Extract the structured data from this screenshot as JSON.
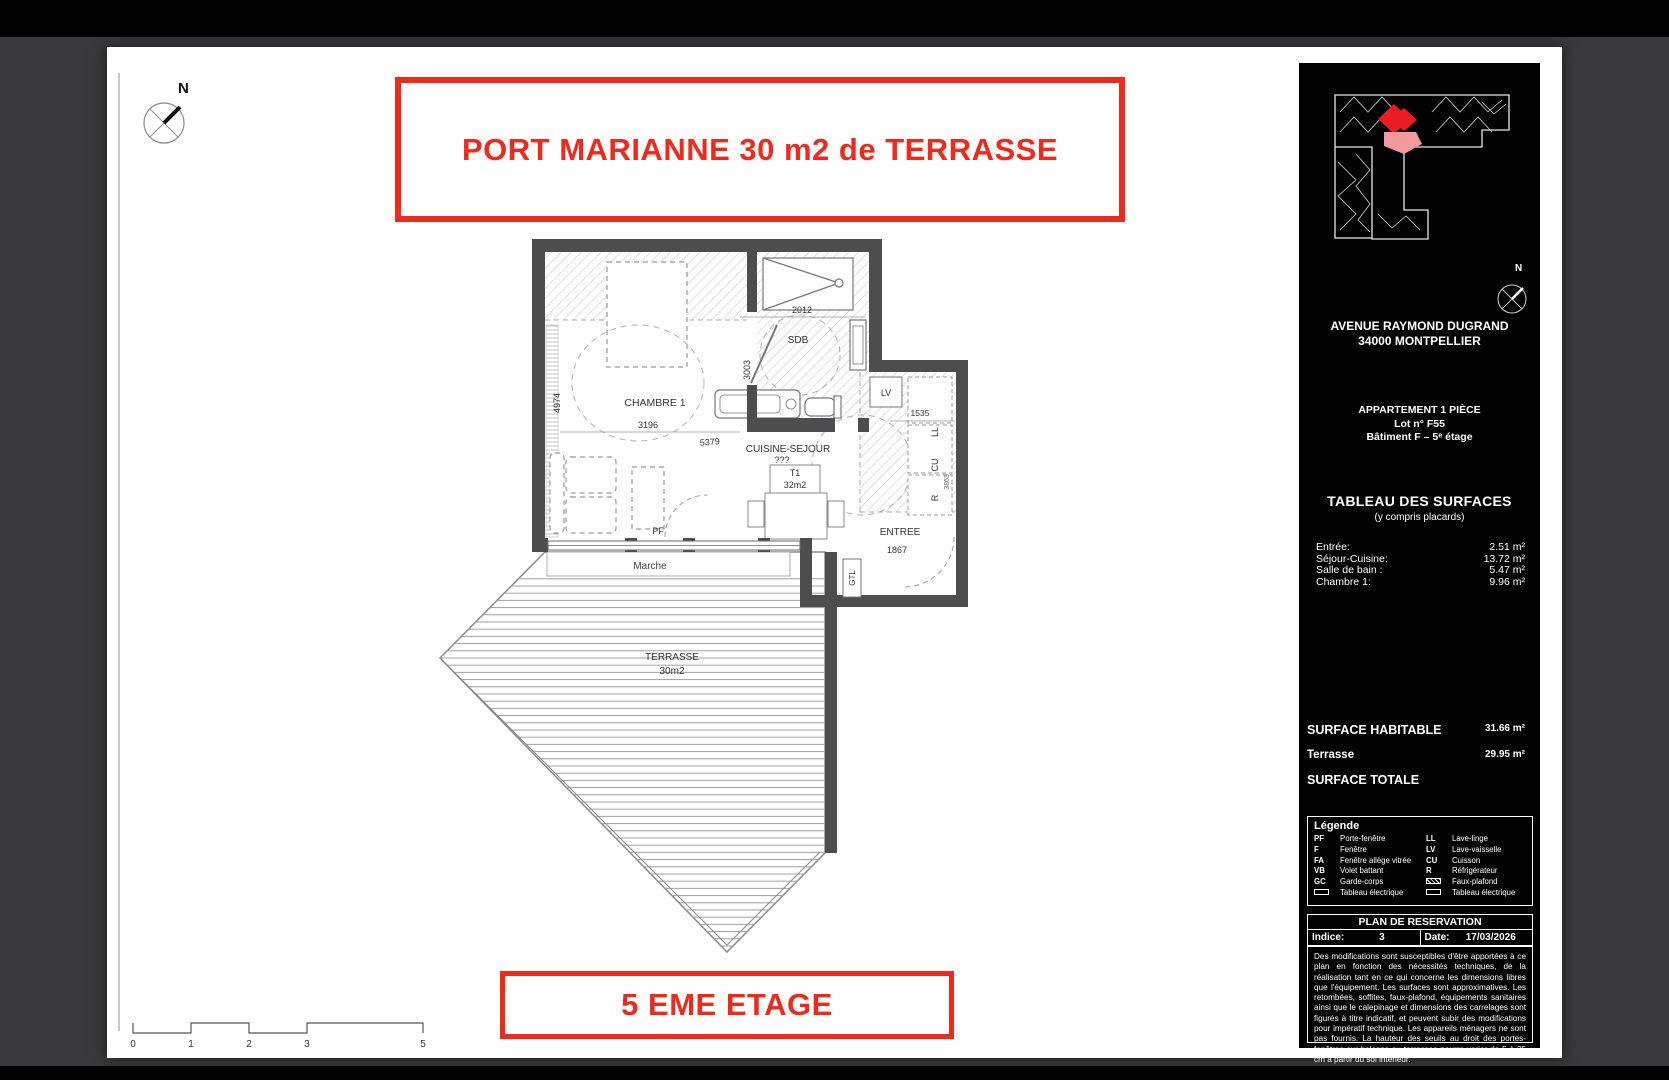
{
  "header": {
    "title": "PORT MARIANNE 30 m2 de TERRASSE"
  },
  "footer": {
    "floor_label": "5 EME ETAGE"
  },
  "compass": {
    "north": "N"
  },
  "scale_bar": {
    "t0": "0",
    "t1": "1",
    "t2": "2",
    "t3": "3",
    "t5": "5"
  },
  "plan": {
    "room_chambre": "CHAMBRE 1",
    "room_sdb": "SDB",
    "room_cuisine": "CUISINE-SEJOUR",
    "cuisine_note": "???",
    "room_entree": "ENTREE",
    "room_terrasse": "TERRASSE",
    "terrasse_area": "30m2",
    "unit_type": "T1",
    "unit_area": "32m2",
    "lbl_pf": "PF",
    "lbl_marche": "Marche",
    "lbl_gtl": "GTL",
    "lbl_lv": "LV",
    "lbl_ll": "LL",
    "lbl_cu": "CU",
    "lbl_r": "R",
    "dim_2012": "2012",
    "dim_3003": "3003",
    "dim_4974": "4974",
    "dim_3196": "3196",
    "dim_5379": "5379",
    "dim_1535": "1535",
    "dim_1867": "1867",
    "dim_3863": "3863"
  },
  "panel": {
    "north": "N",
    "address_line1": "AVENUE RAYMOND DUGRAND",
    "address_line2": "34000 MONTPELLIER",
    "apt_line1": "APPARTEMENT 1 PIÈCE",
    "apt_line2": "Lot n° F55",
    "apt_line3": "Bâtiment F – 5ᵉ étage",
    "surfaces_title": "TABLEAU DES SURFACES",
    "surfaces_subtitle": "(y compris placards)",
    "surfaces": [
      {
        "label": "Entrée:",
        "value": "2.51 m²"
      },
      {
        "label": "Séjour-Cuisine:",
        "value": "13.72 m²"
      },
      {
        "label": "Salle de bain :",
        "value": "5.47 m²"
      },
      {
        "label": "Chambre 1:",
        "value": "9.96 m²"
      }
    ],
    "total_habitable_label": "SURFACE HABITABLE",
    "total_habitable_value": "31.66 m²",
    "terrasse_label": "Terrasse",
    "terrasse_value": "29.95 m²",
    "total_label": "SURFACE TOTALE",
    "legend_title": "Légende",
    "legend_left": [
      {
        "code": "PF",
        "label": "Porte-fenêtre"
      },
      {
        "code": "F",
        "label": "Fenêtre"
      },
      {
        "code": "FA",
        "label": "Fenêtre allège vitrée"
      },
      {
        "code": "VB",
        "label": "Volet battant"
      },
      {
        "code": "GC",
        "label": "Garde-corps"
      },
      {
        "code": "",
        "label": "Tableau électrique"
      }
    ],
    "legend_right": [
      {
        "code": "LL",
        "label": "Lave-linge"
      },
      {
        "code": "LV",
        "label": "Lave-vaisselle"
      },
      {
        "code": "CU",
        "label": "Cuisson"
      },
      {
        "code": "R",
        "label": "Réfrigérateur"
      },
      {
        "code": "",
        "label": "Faux-plafond"
      },
      {
        "code": "",
        "label": "Tableau électrique"
      }
    ],
    "resa_title": "PLAN DE RESERVATION",
    "indice_label": "Indice:",
    "indice_value": "3",
    "date_label": "Date:",
    "date_value": "17/03/2026",
    "disclaimer": "Des modifications sont susceptibles d'être apportées à ce plan en fonction des nécessités techniques, de la réalisation tant en ce qui concerne les dimensions libres que l'équipement. Les surfaces sont approximatives. Les retombées, soffites, faux-plafond, équipements sanitaires ainsi que le calepinage et dimensions des carrelages sont figurés à titre indicatif, et peuvent subir des modifications pour impératif technique. Les appareils ménagers ne sont pas fournis. La hauteur des seuils au droit des portes-fenêtres sur balcons ou terrasses pourra varier de 5 à 35 cm à partir du sol intérieur."
  },
  "colors": {
    "accent_red": "#ee2a1c",
    "wall_gray": "#4d4d4f",
    "panel_bg": "#020202",
    "canvas_bg": "#39393b"
  }
}
